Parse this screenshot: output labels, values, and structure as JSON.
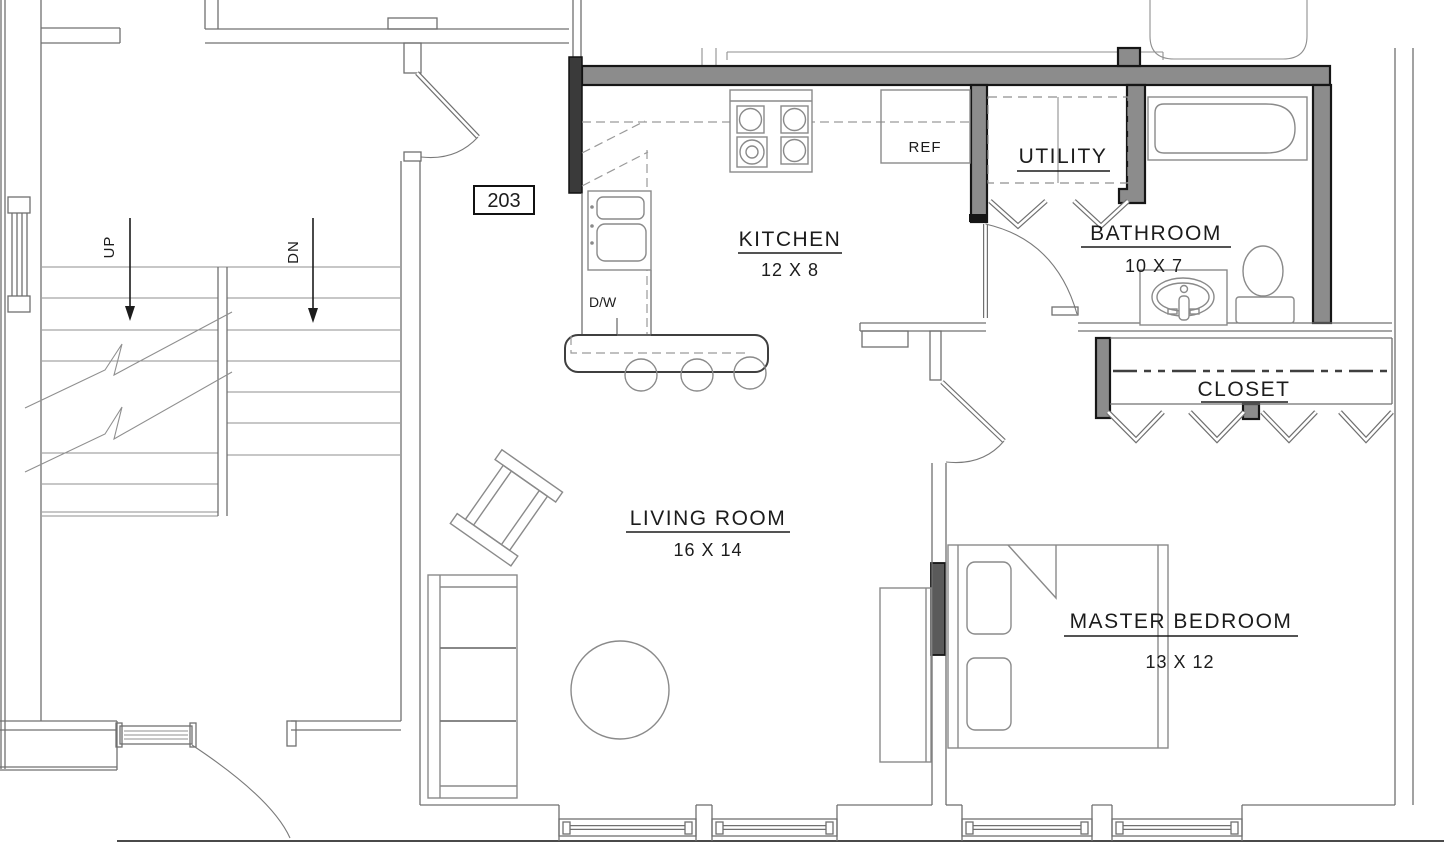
{
  "unit": {
    "number": "203"
  },
  "rooms": {
    "kitchen": {
      "name": "KITCHEN",
      "dims": "12 X 8"
    },
    "living_room": {
      "name": "LIVING ROOM",
      "dims": "16 X 14"
    },
    "master_bedroom": {
      "name": "MASTER BEDROOM",
      "dims": "13 X 12"
    },
    "bathroom": {
      "name": "BATHROOM",
      "dims": "10 X 7"
    },
    "utility": {
      "name": "UTILITY"
    },
    "closet": {
      "name": "CLOSET"
    }
  },
  "labels": {
    "refrigerator": "REF",
    "dishwasher": "D/W",
    "stairs_up": "UP",
    "stairs_down": "DN"
  },
  "colors": {
    "wall_fill": "#8c8c8c",
    "wall_dark": "#2e2e2e",
    "line": "#707070",
    "text": "#1c1c1c",
    "background": "#ffffff"
  }
}
